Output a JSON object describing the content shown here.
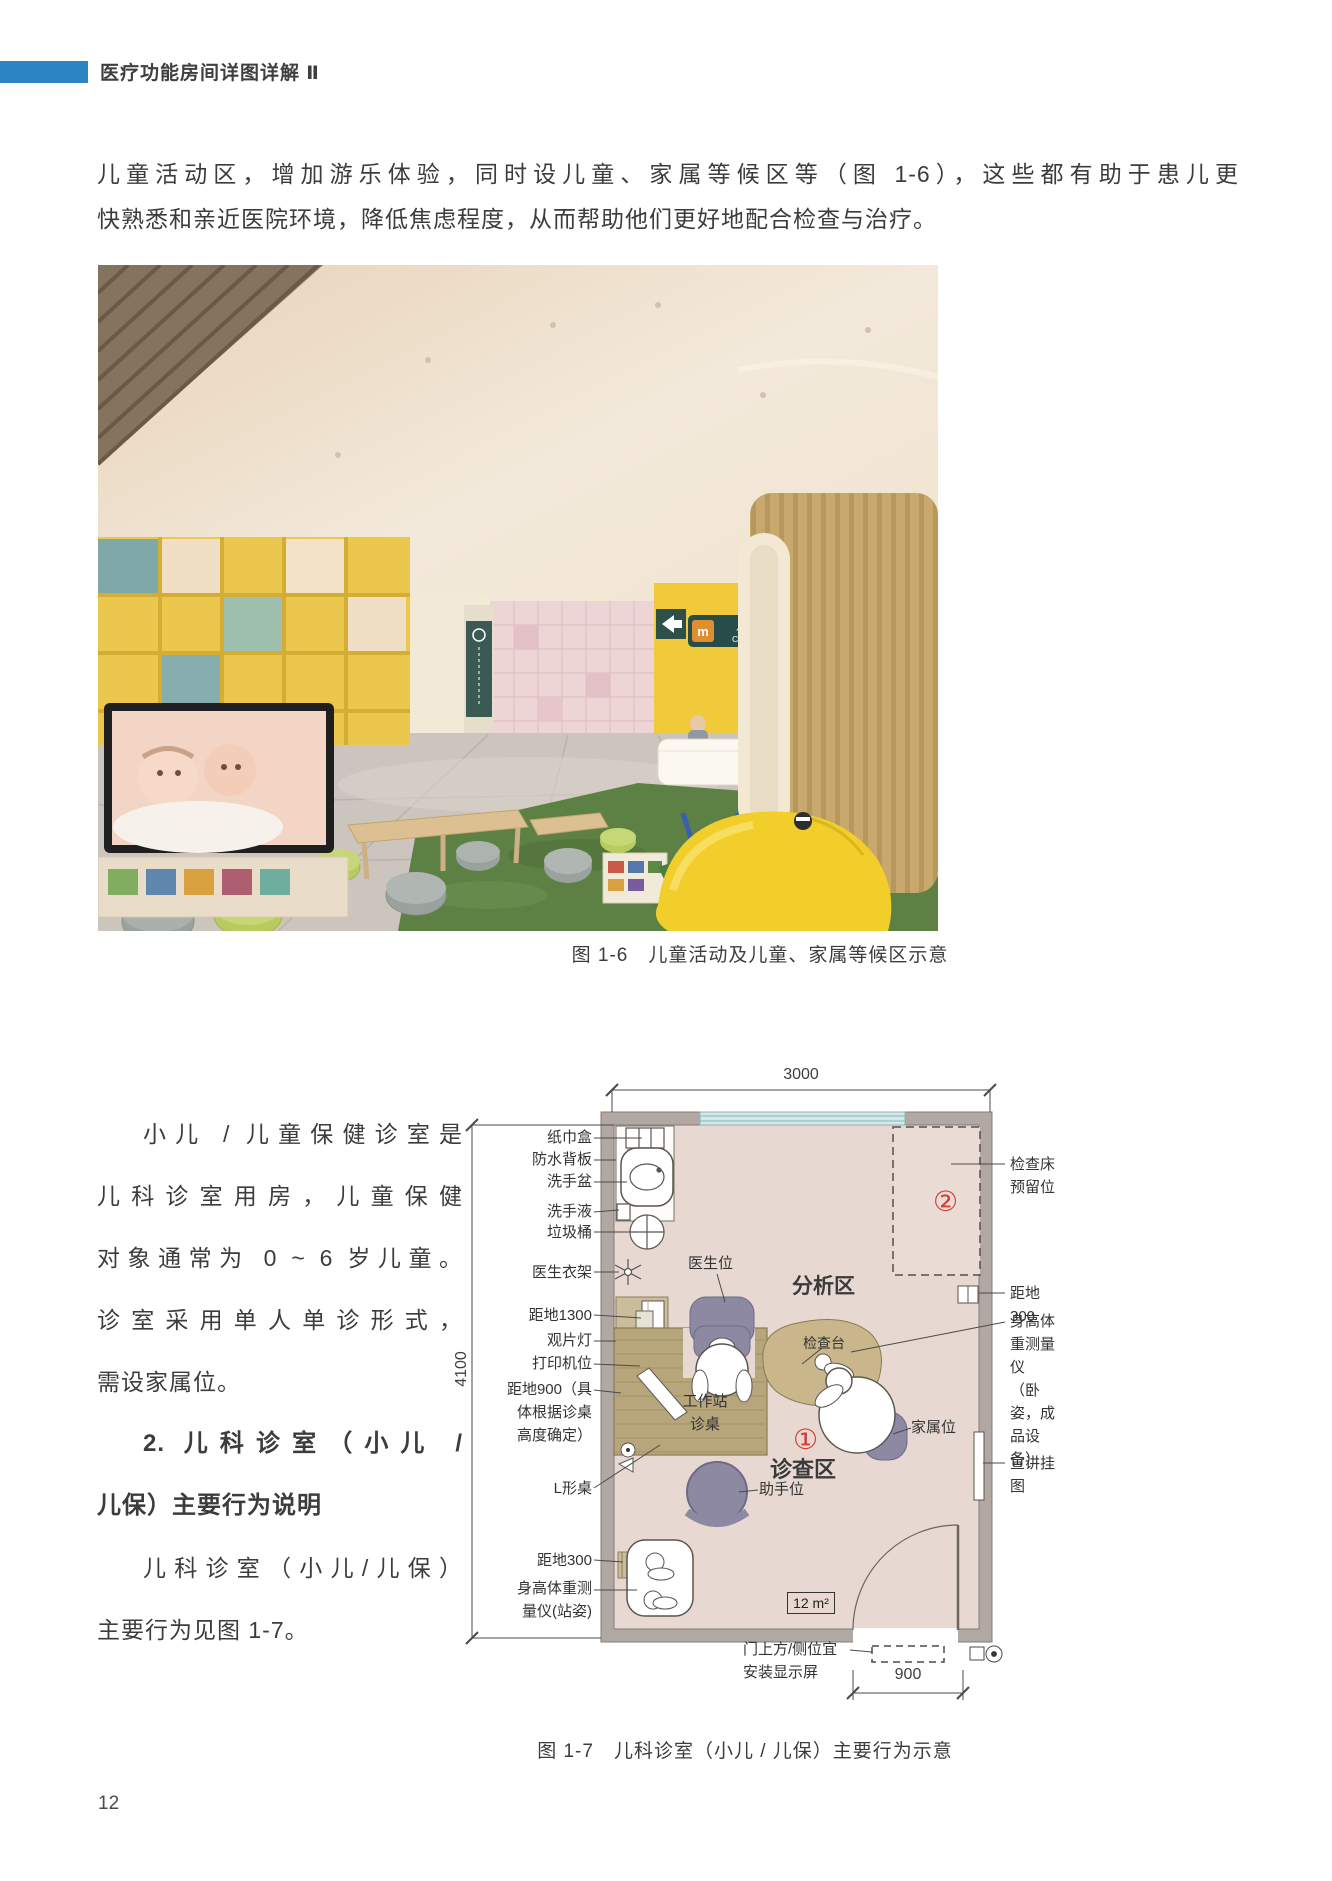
{
  "header": {
    "title": "医疗功能房间详图详解 Ⅱ"
  },
  "intro": {
    "line1": "儿童活动区，增加游乐体验，同时设儿童、家属等候区等（图 1-6），这些都有助于患儿更",
    "line2": "快熟悉和亲近医院环境，降低焦虑程度，从而帮助他们更好地配合检查与治疗。"
  },
  "photo": {
    "sign_cn": "儿童保健中心",
    "sign_en": "Child Care Centre"
  },
  "figure6_caption": "图 1-6　儿童活动及儿童、家属等候区示意",
  "column": {
    "lines": [
      "小儿 / 儿童保健诊室是",
      "儿科诊室用房，儿童保健",
      "对象通常为 0 ~ 6 岁儿童。",
      "诊室采用单人单诊形式，",
      "需设家属位。",
      "2. 儿科诊室（小儿 /",
      "儿保）主要行为说明",
      "儿科诊室（小儿/儿保）",
      "主要行为见图 1-7。"
    ]
  },
  "plan": {
    "dim_top": "3000",
    "dim_left": "4100",
    "dim_door": "900",
    "area": "12 m²",
    "left_labels": [
      "纸巾盒",
      "防水背板",
      "洗手盆",
      "洗手液",
      "垃圾桶",
      "医生衣架",
      "距地1300",
      "观片灯",
      "打印机位",
      "距地900（具\n体根据诊桌\n高度确定）",
      "L形桌",
      "距地300",
      "身高体重测\n量仪(站姿)"
    ],
    "right_labels": [
      "检查床预留位",
      "距地300",
      "身高体重测量仪\n（卧姿，成品设备）",
      "宣讲挂图"
    ],
    "inner": {
      "doctor_seat": "医生位",
      "analysis_zone": "分析区",
      "exam_table": "检查台",
      "workstation": "工作站\n诊桌",
      "marker1": "①",
      "consult_zone": "诊查区",
      "assistant_seat": "助手位",
      "family_seat": "家属位",
      "marker2": "②",
      "door_note": "门上方/侧位宜\n安装显示屏"
    }
  },
  "figure7_caption": "图 1-7　儿科诊室（小儿 / 儿保）主要行为示意",
  "page_number": "12",
  "colors": {
    "accent_blue": "#2b85c2",
    "marker_red": "#d43c38"
  }
}
